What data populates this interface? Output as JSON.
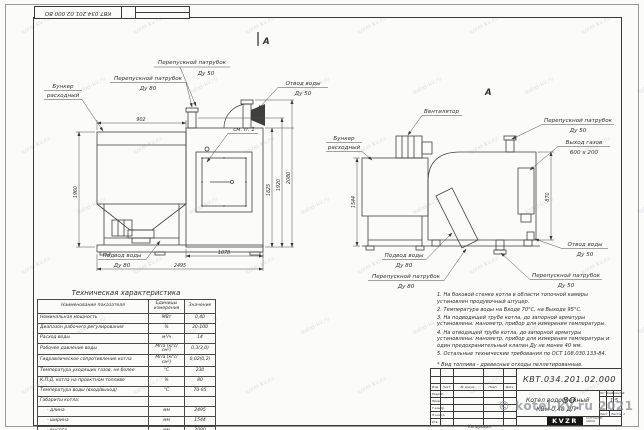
{
  "doc_number": "КВТ.034.201.02.000 ВО",
  "views": {
    "left": {
      "section_mark": "А",
      "callouts": {
        "hopper": [
          "Бункер",
          "расходный"
        ],
        "bypass80": [
          "Перепускной патрубок",
          "Ду 80"
        ],
        "bypass50": [
          "Перепускной патрубок",
          "Ду 50"
        ],
        "water_out": [
          "Отвод воды",
          "Ду 50"
        ],
        "see_note": "см. п. 1",
        "water_in": [
          "Подвод воды",
          "Ду 80"
        ]
      },
      "dims": {
        "hopper_width": "902",
        "height_left": "1960",
        "bottom_1": "1078",
        "bottom_2": "2495",
        "right_1": "1825",
        "right_2": "1920",
        "right_3": "2080"
      }
    },
    "right": {
      "view_mark": "А",
      "callouts": {
        "fan": "Вентилятор",
        "hopper": [
          "Бункер",
          "расходный"
        ],
        "bypass50_top": [
          "Перепускной патрубок",
          "Ду 50"
        ],
        "gas_out": [
          "Выход газов",
          "600 х 200"
        ],
        "water_out": [
          "Отвод воды",
          "Ду 50"
        ],
        "bypass50_bottom": [
          "Перепускной патрубок",
          "Ду 50"
        ],
        "water_in": [
          "Подвод воды",
          "Ду 80"
        ],
        "bypass80": [
          "Перепускной патрубок",
          "Ду 80"
        ]
      },
      "dims": {
        "left": "1544",
        "right": "870"
      }
    }
  },
  "tech_table": {
    "title": "Техническая характеристика",
    "headers": [
      "Наименование показателя",
      "Единицы измерения",
      "Значение"
    ],
    "rows": [
      [
        "Номинальная мощность",
        "МВт",
        "0,40"
      ],
      [
        "Диапазон рабочего регулирования",
        "%",
        "30-100"
      ],
      [
        "Расход воды",
        "м³/ч",
        "14"
      ],
      [
        "Рабочее давление воды",
        "МПа (кгс/см²)",
        "0,3(3,0)"
      ],
      [
        "Гидравлическое сопротивление котла",
        "МПа (кгс/см²)",
        "0,02(0,2)"
      ],
      [
        "Температура уходящих газов, не более",
        "°С",
        "230"
      ],
      [
        "К.П.Д. котла на проектном топливе",
        "%",
        "80"
      ],
      [
        "Температура воды (вход/выход)",
        "°С",
        "70-95"
      ],
      [
        "Габариты котла:",
        "",
        ""
      ],
      [
        "- длина",
        "мм",
        "2495"
      ],
      [
        "- ширина",
        "мм",
        "1544"
      ],
      [
        "- высота",
        "мм",
        "2080"
      ]
    ]
  },
  "notes": {
    "items": [
      "1. На боковой стенке котла в области топочной камеры установлен продувочный штуцер.",
      "2. Температура воды на Входе 70°С, на Выходе 95°С.",
      "3. На подводящей трубе котла, до запорной арматуры установлены: манометр, прибор для измерения температуры.",
      "4. На отводящей трубе котла, до запорной арматуры установлены: манометр, прибор для измерения температуры и один предохранительный клапан Ду не менее 40 мм.",
      "5. Остальные технические требования по ОСТ 108.030.133-84.",
      "* Вид топлива - древесные отходы пеллетированные."
    ]
  },
  "title_block": {
    "product_name": [
      "Котел водогрейный",
      "КВм-0,40 ДП*"
    ],
    "col_lit": "Лит.",
    "col_mass": "Масса",
    "col_scale": "Масштаб",
    "scale": "1:5",
    "sheet_lbl": "Лист",
    "sheets_lbl": "Листов 1",
    "sig_col_headers": [
      "Изм.",
      "Лист",
      "№ докум.",
      "Подп.",
      "Дата"
    ],
    "sig_rows": [
      "Разраб.",
      "Пров.",
      "Т.контр.",
      "Н.контр.",
      "Утв."
    ],
    "logo": "KVZR",
    "logo_caption": [
      "КОТЕЛЬНЫЙ",
      "ЗАВОД"
    ],
    "copied": "Копировал"
  },
  "watermark": {
    "tile": "kotel-kv.ru",
    "corner": "© kotel-kv.ru 2021"
  }
}
